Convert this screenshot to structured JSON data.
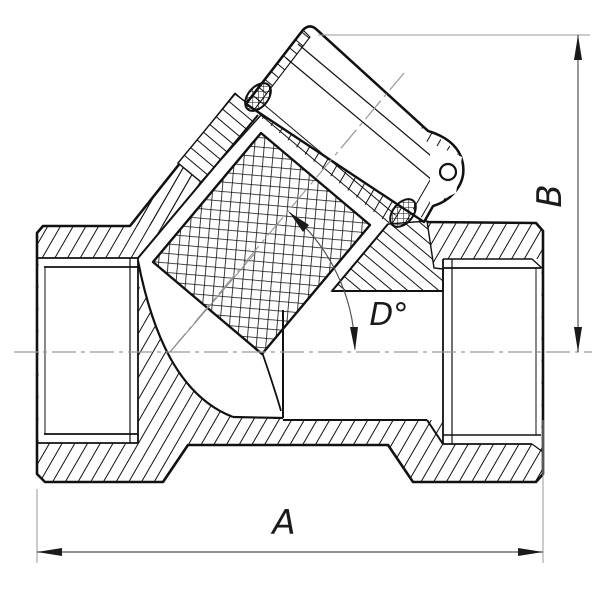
{
  "drawing": {
    "type": "sectional-technical-drawing",
    "labels": {
      "width": "A",
      "height": "B",
      "angle": "D°"
    },
    "colors": {
      "outline": "#111111",
      "hatch": "#111111",
      "dimension_line": "#555555",
      "extension_line": "#9a9a9a",
      "centerline": "#999999",
      "background": "#ffffff"
    }
  }
}
